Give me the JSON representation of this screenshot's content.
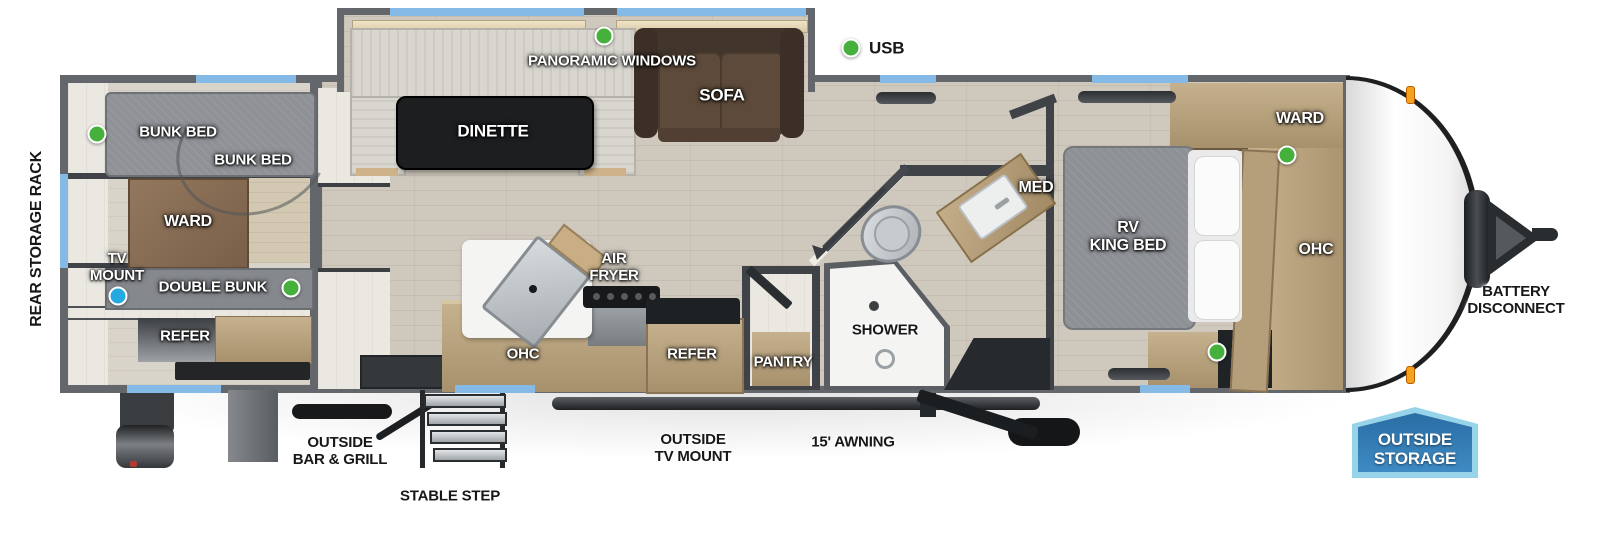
{
  "colors": {
    "wall": "#63676b",
    "wall_dark": "#3f4347",
    "floor": "#cfc8bd",
    "floor_rear": "#d8d4c9",
    "white_wall": "#eae8e1",
    "window": "#85b9e6",
    "usb_green": "#45b13c",
    "tv_blue": "#24a9e0",
    "wood": "#c6b18e",
    "wood_dark": "#a7916c",
    "mattress": "#8d9095",
    "sofa_brown": "#5d4a3a",
    "table_black": "#1c1e20",
    "badge_border": "#97d4ea",
    "badge_top": "#2b6da5",
    "badge_bottom": "#3e8ac2",
    "marker_orange": "#f6a21f"
  },
  "legend": {
    "usb_label": "USB"
  },
  "exterior": {
    "rear_storage_rack": "REAR STORAGE RACK",
    "battery_disconnect": "BATTERY\nDISCONNECT",
    "outside_bar_grill": "OUTSIDE\nBAR & GRILL",
    "stable_step": "STABLE STEP",
    "outside_tv_mount": "OUTSIDE\nTV MOUNT",
    "awning": "15' AWNING",
    "outside_storage": "OUTSIDE\nSTORAGE"
  },
  "rear_room": {
    "bunk_bed_upper": "BUNK BED",
    "bunk_bed_lower": "BUNK BED",
    "ward": "WARD",
    "tv_mount": "TV\nMOUNT",
    "double_bunk": "DOUBLE BUNK",
    "refer": "REFER"
  },
  "slideout": {
    "panoramic_windows": "PANORAMIC WINDOWS",
    "dinette": "DINETTE",
    "sofa": "SOFA"
  },
  "kitchen": {
    "air_fryer": "AIR\nFRYER",
    "ohc": "OHC",
    "refer": "REFER",
    "pantry": "PANTRY"
  },
  "bath": {
    "shower": "SHOWER",
    "med": "MED"
  },
  "bedroom": {
    "rv_king_bed": "RV\nKING BED",
    "ward": "WARD",
    "ohc": "OHC"
  }
}
